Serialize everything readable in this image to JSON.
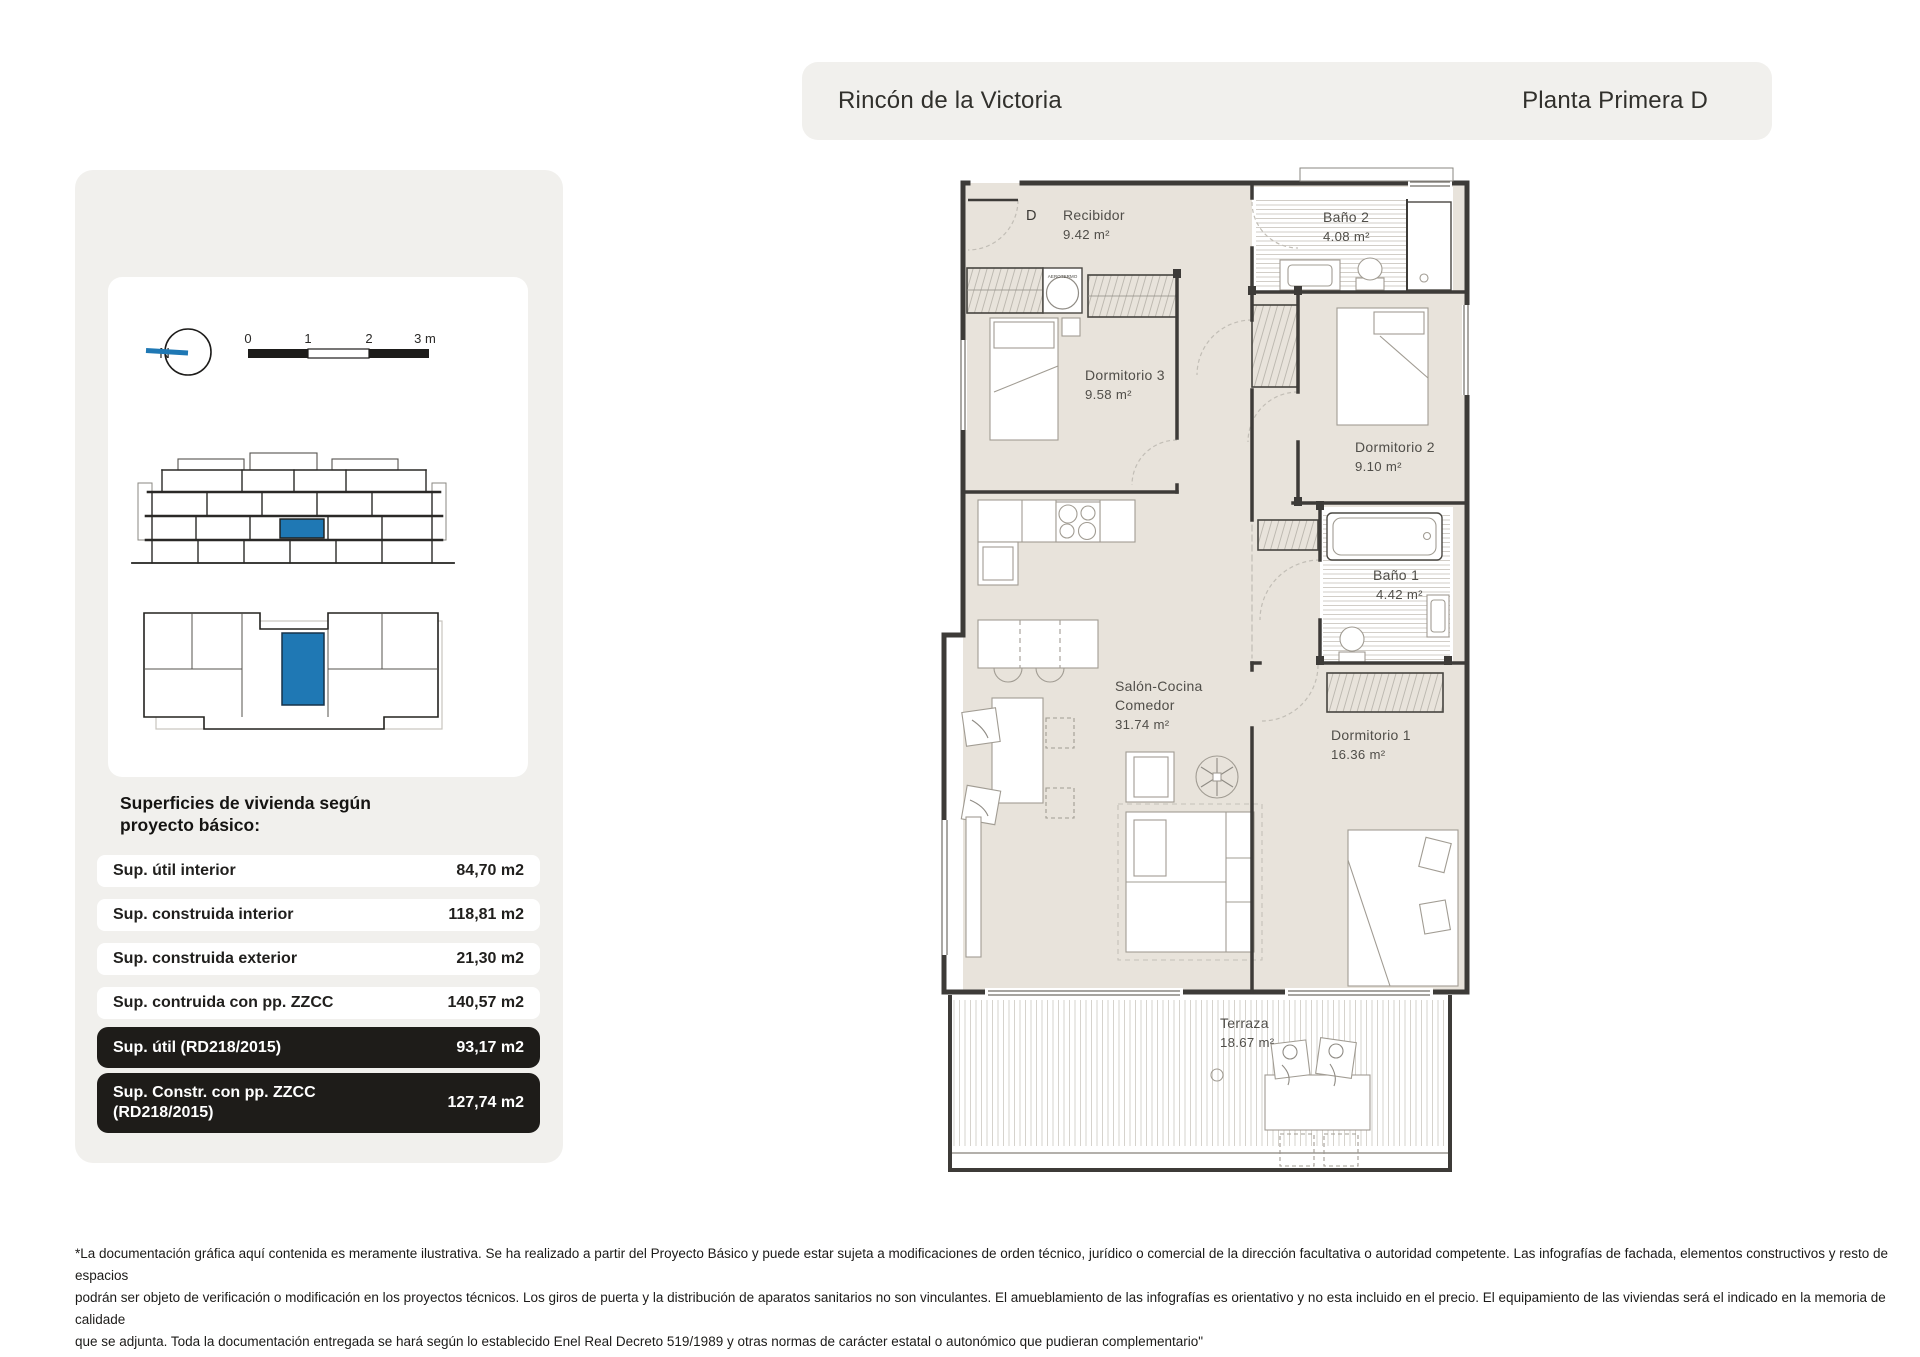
{
  "header": {
    "project_title": "Rincón de la Victoria",
    "plan_title": "Planta Primera D"
  },
  "sidebar": {
    "compass": {
      "north_label": "N"
    },
    "scale_bar": {
      "labels": [
        "0",
        "1",
        "2",
        "3 m"
      ]
    },
    "surfaces": {
      "heading_line1": "Superficies de vivienda según",
      "heading_line2": "proyecto básico:",
      "rows": [
        {
          "label": "Sup. útil interior",
          "value": "84,70 m2"
        },
        {
          "label": "Sup. construida interior",
          "value": "118,81 m2"
        },
        {
          "label": "Sup. construida exterior",
          "value": "21,30 m2"
        },
        {
          "label": "Sup. contruida con pp. ZZCC",
          "value": "140,57 m2"
        },
        {
          "label": "Sup. útil (RD218/2015)",
          "value": "93,17 m2"
        },
        {
          "label": "Sup. Constr. con pp. ZZCC",
          "label_line2": "(RD218/2015)",
          "value": "127,74 m2"
        }
      ]
    }
  },
  "plan": {
    "entry_label": "D",
    "aerotermo_label": "AEROTERMO",
    "rooms": {
      "recibidor": {
        "name": "Recibidor",
        "area": "9.42 m²"
      },
      "bano2": {
        "name": "Baño 2",
        "area": "4.08 m²"
      },
      "dormitorio3": {
        "name": "Dormitorio 3",
        "area": "9.58 m²"
      },
      "dormitorio2": {
        "name": "Dormitorio 2",
        "area": "9.10 m²"
      },
      "bano1": {
        "name": "Baño 1",
        "area": "4.42 m²"
      },
      "salon": {
        "name_line1": "Salón-Cocina",
        "name_line2": "Comedor",
        "area": "31.74 m²"
      },
      "dormitorio1": {
        "name": "Dormitorio 1",
        "area": "16.36 m²"
      },
      "terraza": {
        "name": "Terraza",
        "area": "18.67 m²"
      }
    }
  },
  "footer": {
    "lines": [
      "*La documentación gráfica aquí contenida es meramente ilustrativa. Se ha realizado a partir del Proyecto Básico y puede estar sujeta a modificaciones de orden técnico, jurídico o comercial de la dirección facultativa o autoridad competente. Las infografías de fachada, elementos constructivos y resto de espacios",
      "podrán ser objeto de verificación o modificación en los proyectos técnicos. Los giros de puerta y la distribución de aparatos sanitarios no son vinculantes. El amueblamiento de las infografías es orientativo y no esta incluido en el precio. El equipamiento de las viviendas será el indicado en la memoria de calidade",
      "que se adjunta. Toda la documentación entregada se hará según lo establecido Enel Real Decreto 519/1989 y otras normas de carácter estatal o autonómico que pudieran complementario\""
    ]
  },
  "colors": {
    "accent_blue": "#1f78b4",
    "panel_gray": "#f1f0ed",
    "floor_beige": "#e8e3db",
    "wall": "#3d3b38",
    "dark_row": "#1e1c19"
  }
}
